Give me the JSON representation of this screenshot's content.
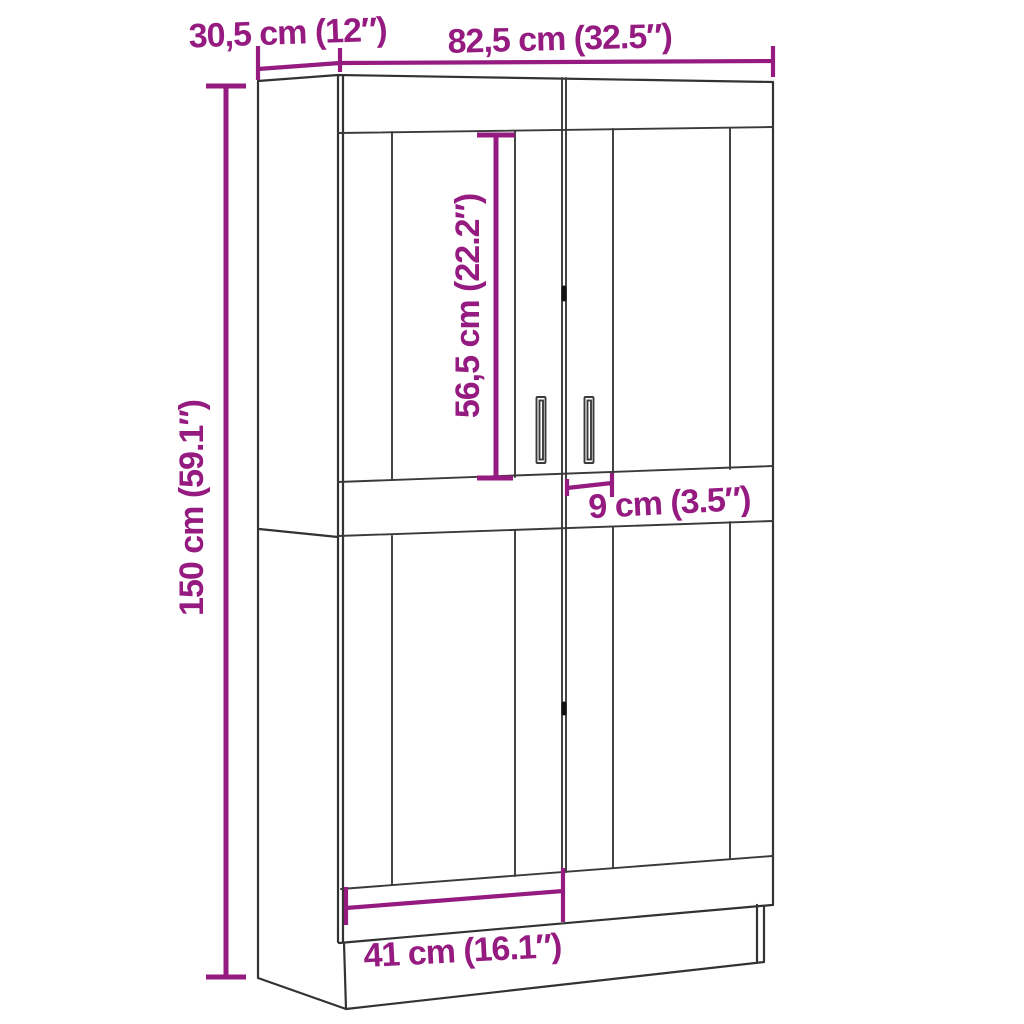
{
  "page": {
    "background": "#ffffff"
  },
  "diagram": {
    "kind": "furniture-dimension-diagram",
    "subject": "two-door highboard cabinet line drawing",
    "colors": {
      "dimension_accent": "#951b81",
      "outline": "#333333"
    },
    "dimensions": {
      "depth": {
        "label": "30,5 cm (12″)",
        "cm": "30,5",
        "inches": "12"
      },
      "width": {
        "label": "82,5 cm (32.5″)",
        "cm": "82,5",
        "inches": "32.5"
      },
      "height": {
        "label": "150 cm (59.1″)",
        "cm": "150",
        "inches": "59.1"
      },
      "panel_height": {
        "label": "56,5 cm (22.2″)",
        "cm": "56,5",
        "inches": "22.2"
      },
      "stile_width": {
        "label": "9 cm (3.5″)",
        "cm": "9",
        "inches": "3.5"
      },
      "door_width": {
        "label": "41 cm (16.1″)",
        "cm": "41",
        "inches": "16.1"
      }
    }
  }
}
